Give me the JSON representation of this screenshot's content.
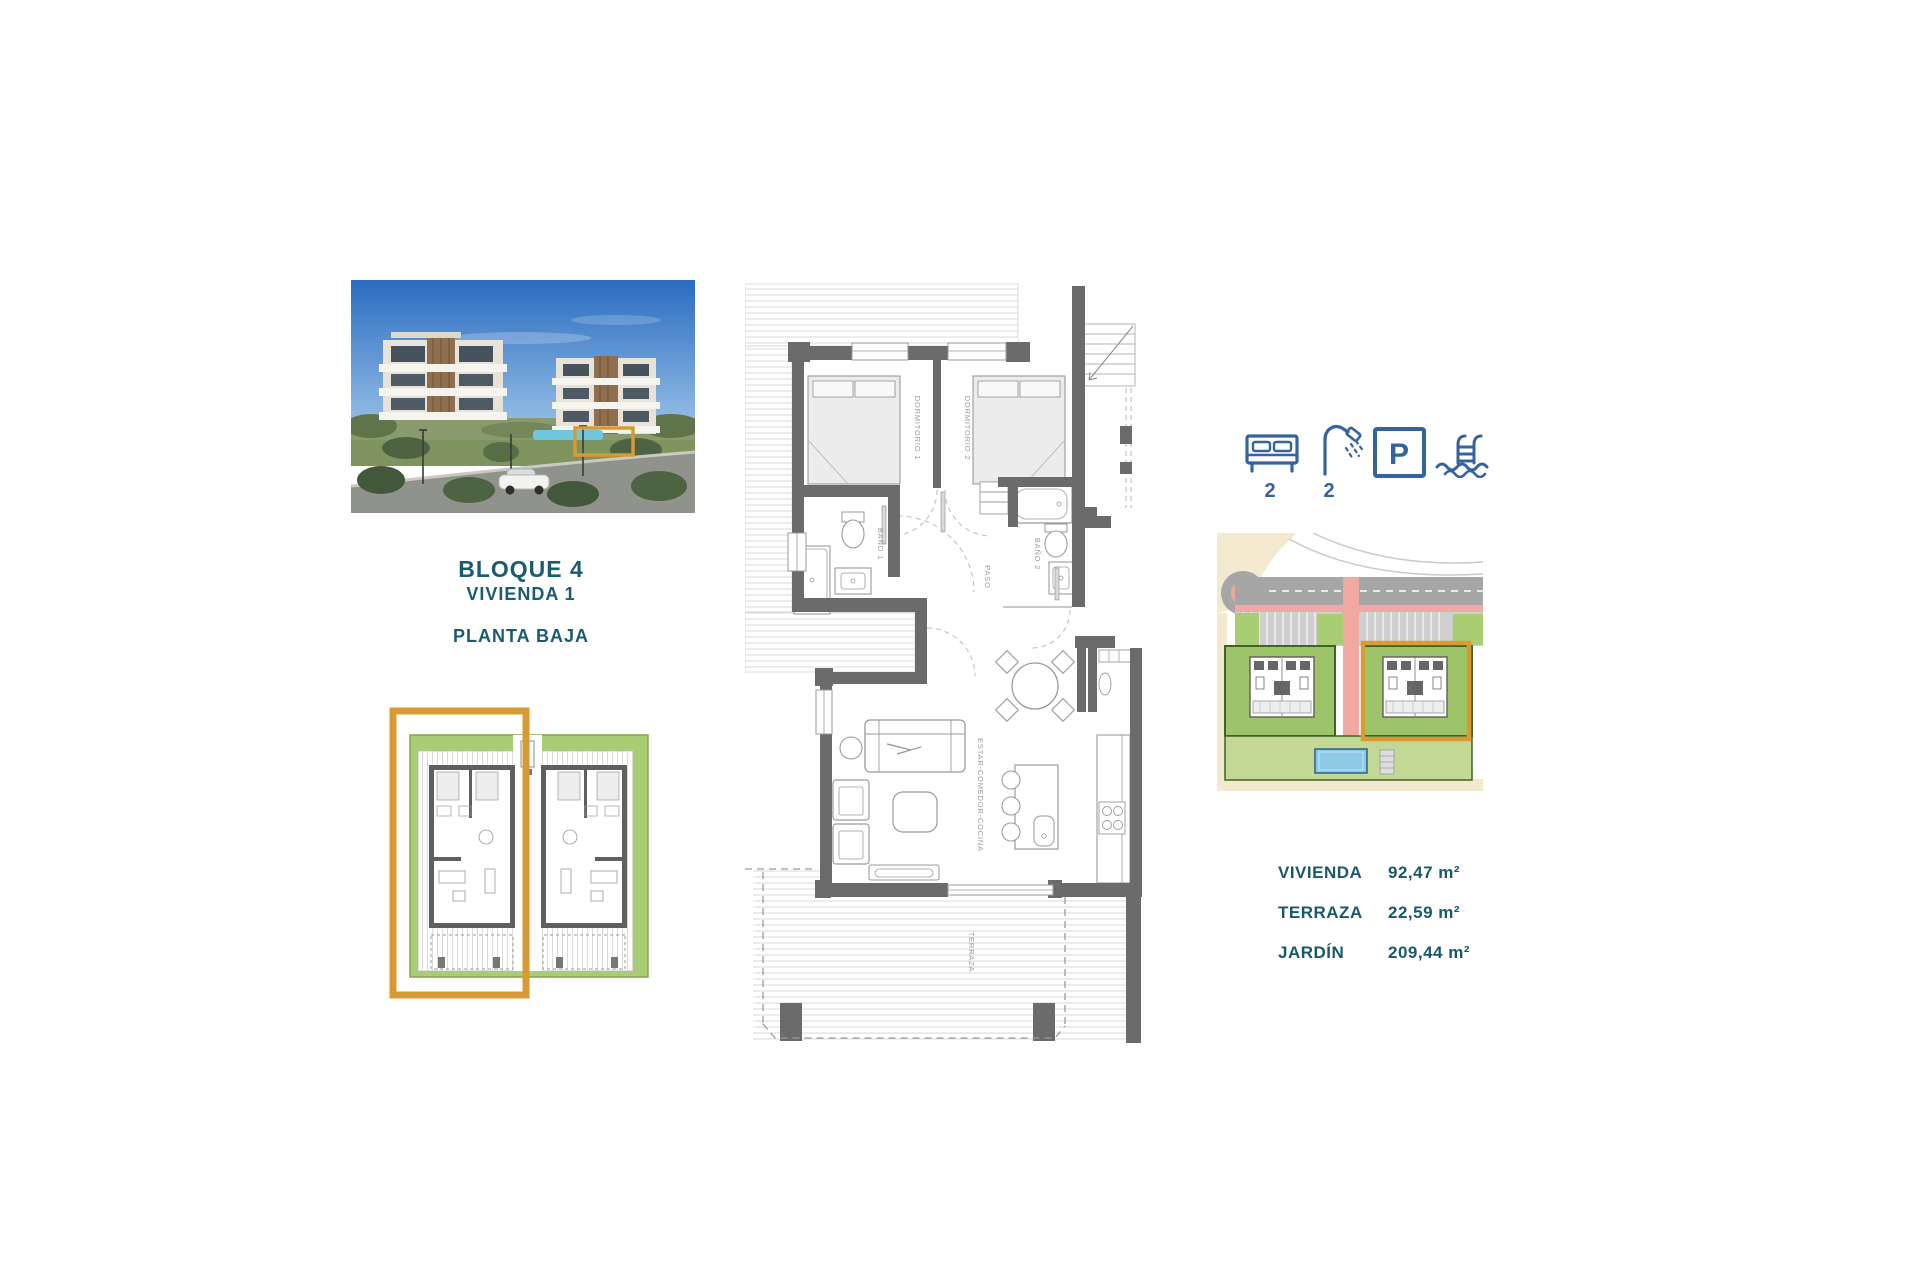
{
  "header": {
    "block_label": "BLOQUE 4",
    "unit_label": "VIVIENDA 1",
    "floor_label": "PLANTA BAJA"
  },
  "photo": {
    "description": "Exterior render of two modern apartment blocks with gardens, pool, street and car; ground-floor unit outlined in orange"
  },
  "features": {
    "bedrooms_count": "2",
    "bathrooms_count": "2",
    "parking_letter": "P",
    "icons": [
      "bed-icon",
      "shower-icon",
      "parking-icon",
      "pool-icon"
    ]
  },
  "floor_plan": {
    "room_labels": {
      "bedroom1": "DORMITORIO 1",
      "bedroom2": "DORMITORIO 2",
      "bath1": "BAÑO 1",
      "bath2": "BAÑO 2",
      "hall": "PASO",
      "living": "ESTAR-COMEDOR-COCINA",
      "terrace": "TERRAZA"
    }
  },
  "areas": {
    "rows": [
      {
        "label": "VIVIENDA",
        "value": "92,47 m²"
      },
      {
        "label": "TERRAZA",
        "value": "22,59 m²"
      },
      {
        "label": "JARDÍN",
        "value": "209,44 m²"
      }
    ]
  },
  "colors": {
    "accent_orange": "#d89a33",
    "icon_blue": "#35639f",
    "text_teal": "#1b5b70",
    "wall_gray": "#6b6b6b",
    "site_green": "#9dc468",
    "site_green_light": "#c2d894",
    "road_pink": "#f0a9a2",
    "pool_blue": "#8cc9e4"
  }
}
